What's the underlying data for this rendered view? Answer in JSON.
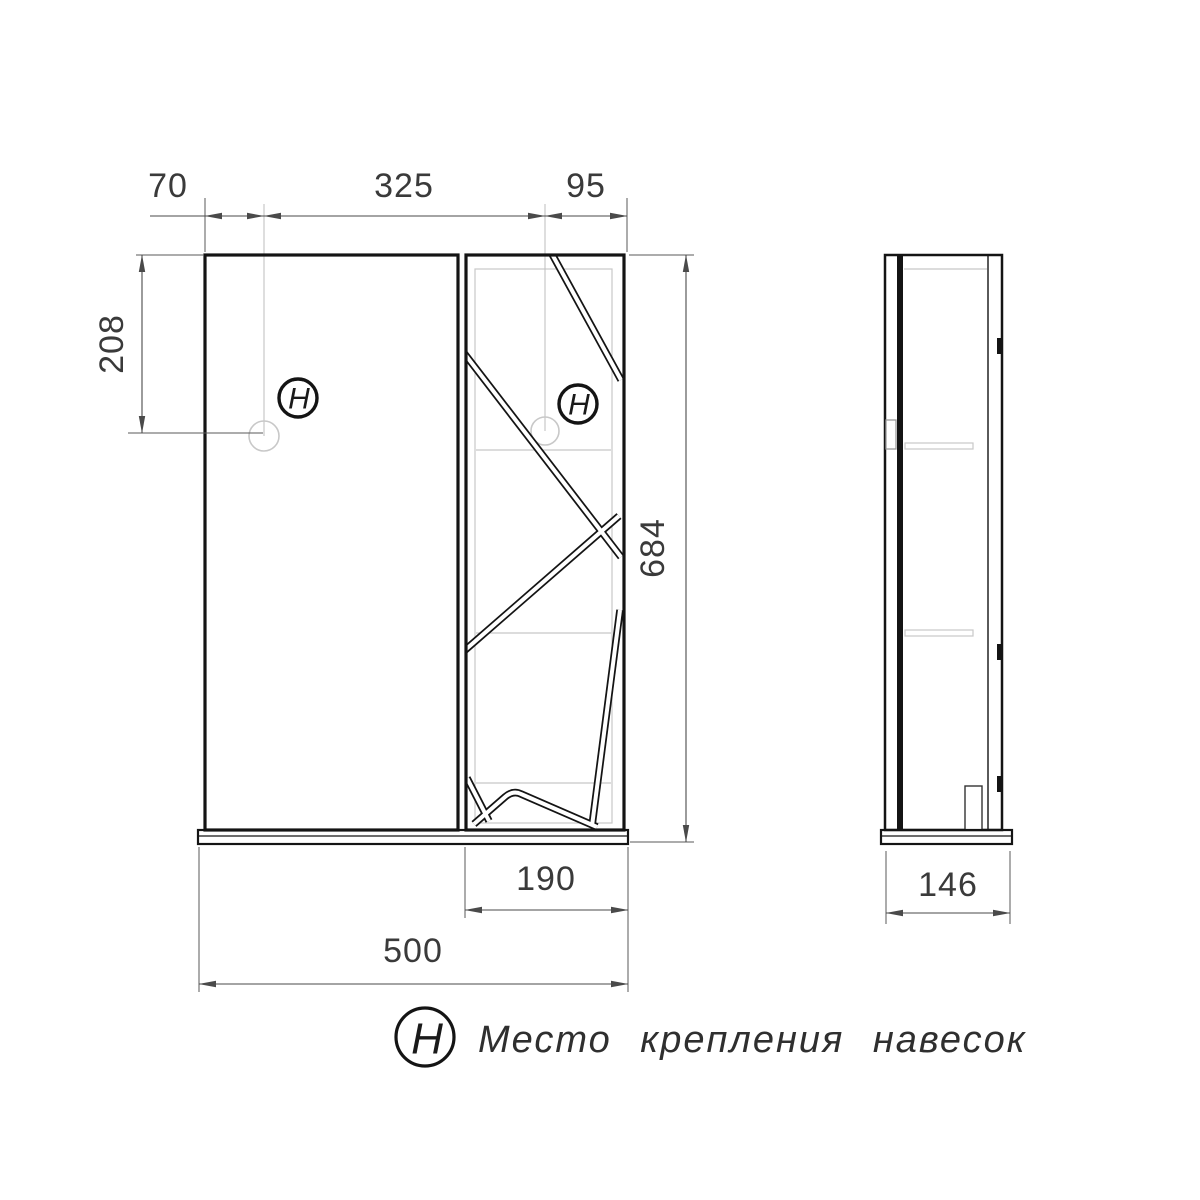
{
  "drawing": {
    "type": "furniture technical drawing, bathroom mirror cabinet, front and side views"
  },
  "dimensions": {
    "top_offset_left": "70",
    "top_center": "325",
    "top_offset_right": "95",
    "hook_height": "208",
    "total_height": "684",
    "cabinet_width": "190",
    "total_width": "500",
    "depth": "146"
  },
  "symbols": {
    "hook_marker": "H"
  },
  "legend": {
    "symbol": "H",
    "text": "Место крепления навесок"
  },
  "colors": {
    "outline": "#141414",
    "dimension": "#4a4a4a",
    "light_gray": "#c8c8c8",
    "background": "#ffffff"
  }
}
